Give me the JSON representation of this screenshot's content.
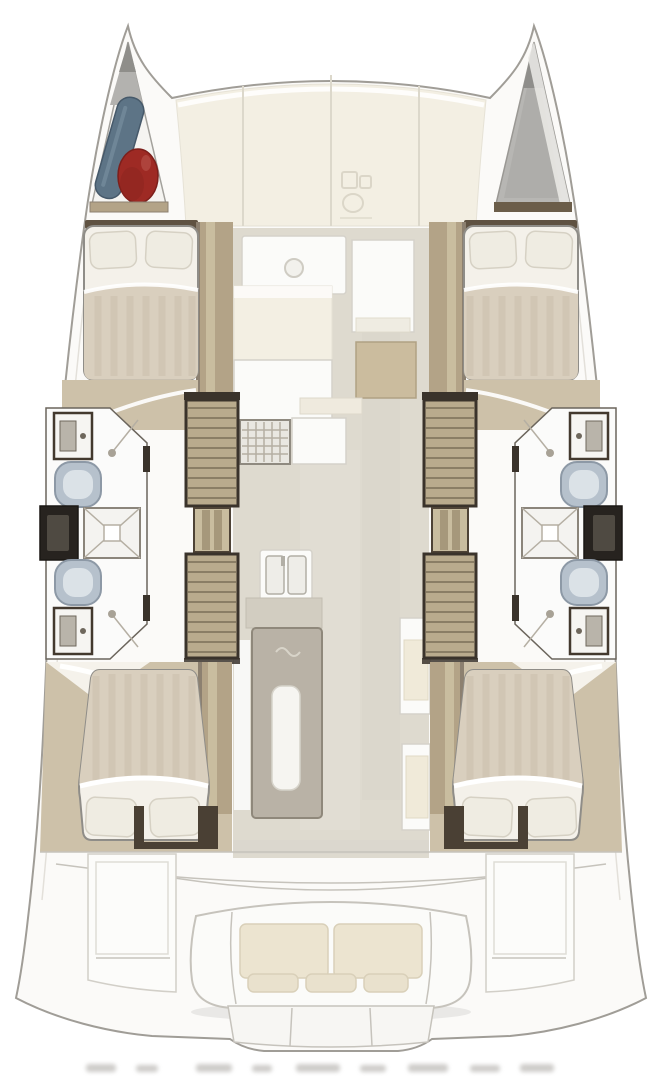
{
  "page": {
    "background": "#ffffff"
  },
  "diagram": {
    "type": "yacht-deck-floorplan",
    "view": "top-down",
    "orientation": "bows-up",
    "description": "sailing catamaran interior layout plan"
  },
  "vessel": {
    "hulls": 2,
    "cabins": [
      {
        "id": "port-forward-cabin",
        "bed": "double",
        "pillows": 2
      },
      {
        "id": "starboard-forward-cabin",
        "bed": "double",
        "pillows": 2
      },
      {
        "id": "port-aft-cabin",
        "bed": "double",
        "pillows": 2
      },
      {
        "id": "starboard-aft-cabin",
        "bed": "double",
        "pillows": 2
      }
    ],
    "bathrooms": [
      {
        "id": "port-forward-head",
        "fixtures": [
          "sink",
          "toilet",
          "shower"
        ]
      },
      {
        "id": "port-aft-head",
        "fixtures": [
          "toilet",
          "sink",
          "shower"
        ]
      },
      {
        "id": "starboard-forward-head",
        "fixtures": [
          "sink",
          "toilet",
          "shower"
        ]
      },
      {
        "id": "starboard-aft-head",
        "fixtures": [
          "toilet",
          "sink",
          "shower"
        ]
      }
    ],
    "shower_pans": 2,
    "companionway_stairs": 2,
    "salon": {
      "galley": [
        "stove",
        "counters",
        "double-sink"
      ],
      "table": 1,
      "side_seats": 2,
      "forward_seat_with_hatch": 1
    },
    "cockpit": {
      "bench_cushions": 2,
      "back_cushions": 3,
      "side_platforms": 2,
      "transom_steps": 3
    },
    "bow": {
      "port_locker_items": [
        "blue-fender",
        "red-buoy"
      ],
      "starboard_locker": "covered-gray"
    }
  },
  "colors": {
    "outline": "#a09d97",
    "deck": "#fbfaf8",
    "panel-cream": "#f3efe3",
    "panel-line": "#dcd8cb",
    "wood": "#b3a387",
    "wood-light": "#c9bd9f",
    "wood-dark": "#6b5d49",
    "stair": "#b9ab8d",
    "stair-line": "#7b6f58",
    "frame-dark": "#3a332b",
    "floor": "#dedacf",
    "floor-wood": "#cdc1a9",
    "sheet": "#f4f1ea",
    "blanket": "#d9cfbe",
    "stripe": "#cbc0ab",
    "pillow": "#efece2",
    "toilet": "#b6c1cc",
    "toilet-edge": "#8d99a6",
    "vanity": "#27231f",
    "fender-blue": "#5d7486",
    "buoy-red": "#9e2a24",
    "locker-gray": "#b7b6b3",
    "cushion": "#ece4d0",
    "table": "#b9b2a6"
  }
}
